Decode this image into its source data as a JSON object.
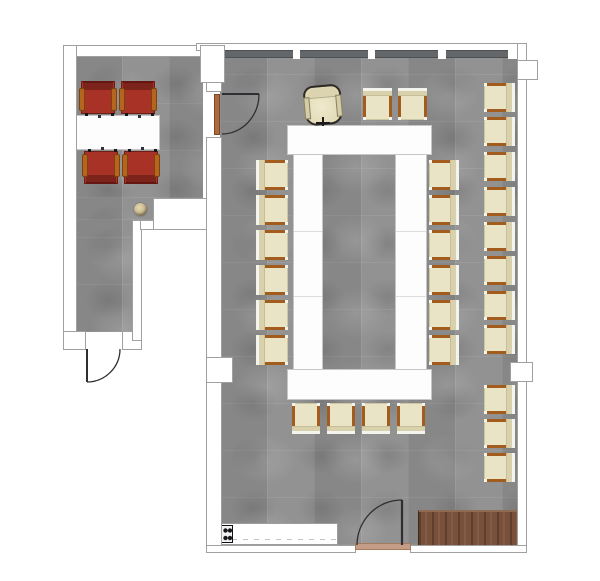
{
  "meta": {
    "kind": "floor-plan",
    "areas": [
      "conference-room",
      "side-office",
      "entry-corridor"
    ]
  },
  "palette": {
    "carpet": "#8e8e8e",
    "wall_fill": "#ffffff",
    "wall_line": "#a0a0a0",
    "glass_wall": "#64676a",
    "table_white": "#fdfdfd",
    "chair_cream_seat": "#eae4c6",
    "chair_cream_back": "#d8d1ac",
    "chair_arm_brown": "#a15c1e",
    "chair_red": "#a93226",
    "chair_red_back": "#7c231b",
    "wood_table": "#79503a",
    "door_threshold": "#c59c85",
    "door_leaf": "#2f2f33"
  },
  "counts": {
    "cream_conference_chairs": 29,
    "red_task_chairs": 4,
    "executive_chairs": 1,
    "doors": 3,
    "tables": 7
  },
  "furniture": {
    "chairs": [
      {
        "name": "conference-chair",
        "type": "cream",
        "face": "left",
        "x": 484,
        "y": 83,
        "w": 31,
        "h": 29
      },
      {
        "name": "conference-chair",
        "type": "cream",
        "face": "left",
        "x": 484,
        "y": 117,
        "w": 31,
        "h": 29
      },
      {
        "name": "conference-chair",
        "type": "cream",
        "face": "left",
        "x": 484,
        "y": 152,
        "w": 31,
        "h": 29
      },
      {
        "name": "conference-chair",
        "type": "cream",
        "face": "left",
        "x": 484,
        "y": 187,
        "w": 31,
        "h": 29
      },
      {
        "name": "conference-chair",
        "type": "cream",
        "face": "left",
        "x": 484,
        "y": 222,
        "w": 31,
        "h": 29
      },
      {
        "name": "conference-chair",
        "type": "cream",
        "face": "left",
        "x": 484,
        "y": 256,
        "w": 31,
        "h": 29
      },
      {
        "name": "conference-chair",
        "type": "cream",
        "face": "left",
        "x": 484,
        "y": 291,
        "w": 31,
        "h": 29
      },
      {
        "name": "conference-chair",
        "type": "cream",
        "face": "left",
        "x": 484,
        "y": 325,
        "w": 31,
        "h": 29
      },
      {
        "name": "conference-chair",
        "type": "cream",
        "face": "left",
        "x": 484,
        "y": 385,
        "w": 31,
        "h": 29
      },
      {
        "name": "conference-chair",
        "type": "cream",
        "face": "left",
        "x": 484,
        "y": 419,
        "w": 31,
        "h": 29
      },
      {
        "name": "conference-chair",
        "type": "cream",
        "face": "left",
        "x": 484,
        "y": 453,
        "w": 31,
        "h": 29
      },
      {
        "name": "conference-chair",
        "type": "cream",
        "face": "left",
        "x": 429,
        "y": 160,
        "w": 30,
        "h": 30
      },
      {
        "name": "conference-chair",
        "type": "cream",
        "face": "left",
        "x": 429,
        "y": 195,
        "w": 30,
        "h": 30
      },
      {
        "name": "conference-chair",
        "type": "cream",
        "face": "left",
        "x": 429,
        "y": 230,
        "w": 30,
        "h": 30
      },
      {
        "name": "conference-chair",
        "type": "cream",
        "face": "left",
        "x": 429,
        "y": 265,
        "w": 30,
        "h": 30
      },
      {
        "name": "conference-chair",
        "type": "cream",
        "face": "left",
        "x": 429,
        "y": 300,
        "w": 30,
        "h": 30
      },
      {
        "name": "conference-chair",
        "type": "cream",
        "face": "left",
        "x": 429,
        "y": 335,
        "w": 30,
        "h": 30
      },
      {
        "name": "conference-chair",
        "type": "cream",
        "face": "right",
        "x": 256,
        "y": 160,
        "w": 32,
        "h": 30
      },
      {
        "name": "conference-chair",
        "type": "cream",
        "face": "right",
        "x": 256,
        "y": 195,
        "w": 32,
        "h": 30
      },
      {
        "name": "conference-chair",
        "type": "cream",
        "face": "right",
        "x": 256,
        "y": 230,
        "w": 32,
        "h": 30
      },
      {
        "name": "conference-chair",
        "type": "cream",
        "face": "right",
        "x": 256,
        "y": 265,
        "w": 32,
        "h": 30
      },
      {
        "name": "conference-chair",
        "type": "cream",
        "face": "right",
        "x": 256,
        "y": 300,
        "w": 32,
        "h": 30
      },
      {
        "name": "conference-chair",
        "type": "cream",
        "face": "right",
        "x": 256,
        "y": 335,
        "w": 32,
        "h": 30
      },
      {
        "name": "conference-chair",
        "type": "cream",
        "face": "down",
        "x": 363,
        "y": 88,
        "w": 29,
        "h": 32
      },
      {
        "name": "conference-chair",
        "type": "cream",
        "face": "down",
        "x": 398,
        "y": 88,
        "w": 29,
        "h": 32
      },
      {
        "name": "conference-chair",
        "type": "cream",
        "face": "up",
        "x": 292,
        "y": 403,
        "w": 28,
        "h": 31
      },
      {
        "name": "conference-chair",
        "type": "cream",
        "face": "up",
        "x": 327,
        "y": 403,
        "w": 28,
        "h": 31
      },
      {
        "name": "conference-chair",
        "type": "cream",
        "face": "up",
        "x": 362,
        "y": 403,
        "w": 28,
        "h": 31
      },
      {
        "name": "conference-chair",
        "type": "cream",
        "face": "up",
        "x": 397,
        "y": 403,
        "w": 28,
        "h": 31
      },
      {
        "name": "red-task-chair",
        "type": "red",
        "face": "down",
        "x": 81,
        "y": 81,
        "w": 34,
        "h": 33
      },
      {
        "name": "red-task-chair",
        "type": "red",
        "face": "down",
        "x": 121,
        "y": 81,
        "w": 34,
        "h": 33
      },
      {
        "name": "red-task-chair",
        "type": "red",
        "face": "up",
        "x": 84,
        "y": 151,
        "w": 34,
        "h": 33
      },
      {
        "name": "red-task-chair",
        "type": "red",
        "face": "up",
        "x": 124,
        "y": 151,
        "w": 34,
        "h": 33
      },
      {
        "name": "executive-chair",
        "type": "executive",
        "face": "down",
        "x": 304,
        "y": 85,
        "w": 38,
        "h": 40
      }
    ],
    "tables": [
      {
        "name": "side-room-table",
        "finish": "white",
        "x": 75,
        "y": 115,
        "w": 85,
        "h": 35
      },
      {
        "name": "u-table-top",
        "finish": "white",
        "x": 287,
        "y": 125,
        "w": 145,
        "h": 30
      },
      {
        "name": "u-table-left-leg",
        "finish": "white",
        "x": 293,
        "y": 154,
        "w": 30,
        "h": 216,
        "seams": [
          76,
          141
        ]
      },
      {
        "name": "u-table-right-leg",
        "finish": "white",
        "x": 395,
        "y": 154,
        "w": 32,
        "h": 216,
        "seams": [
          76,
          141
        ]
      },
      {
        "name": "u-table-bottom",
        "finish": "white",
        "x": 287,
        "y": 369,
        "w": 145,
        "h": 31
      },
      {
        "name": "kitchen-counter",
        "finish": "counter",
        "x": 218,
        "y": 523,
        "w": 120,
        "h": 22
      },
      {
        "name": "wood-sideboard",
        "finish": "wood",
        "x": 418,
        "y": 510,
        "w": 100,
        "h": 37
      }
    ],
    "objects": [
      {
        "name": "stove-symbol",
        "x": 221,
        "y": 525,
        "w": 12,
        "h": 18
      },
      {
        "name": "waste-bin",
        "x": 133,
        "y": 202,
        "w": 15,
        "h": 15
      }
    ]
  },
  "doors": [
    {
      "name": "side-room-to-conference-door"
    },
    {
      "name": "side-room-entrance-door"
    },
    {
      "name": "conference-room-entrance-door"
    }
  ]
}
